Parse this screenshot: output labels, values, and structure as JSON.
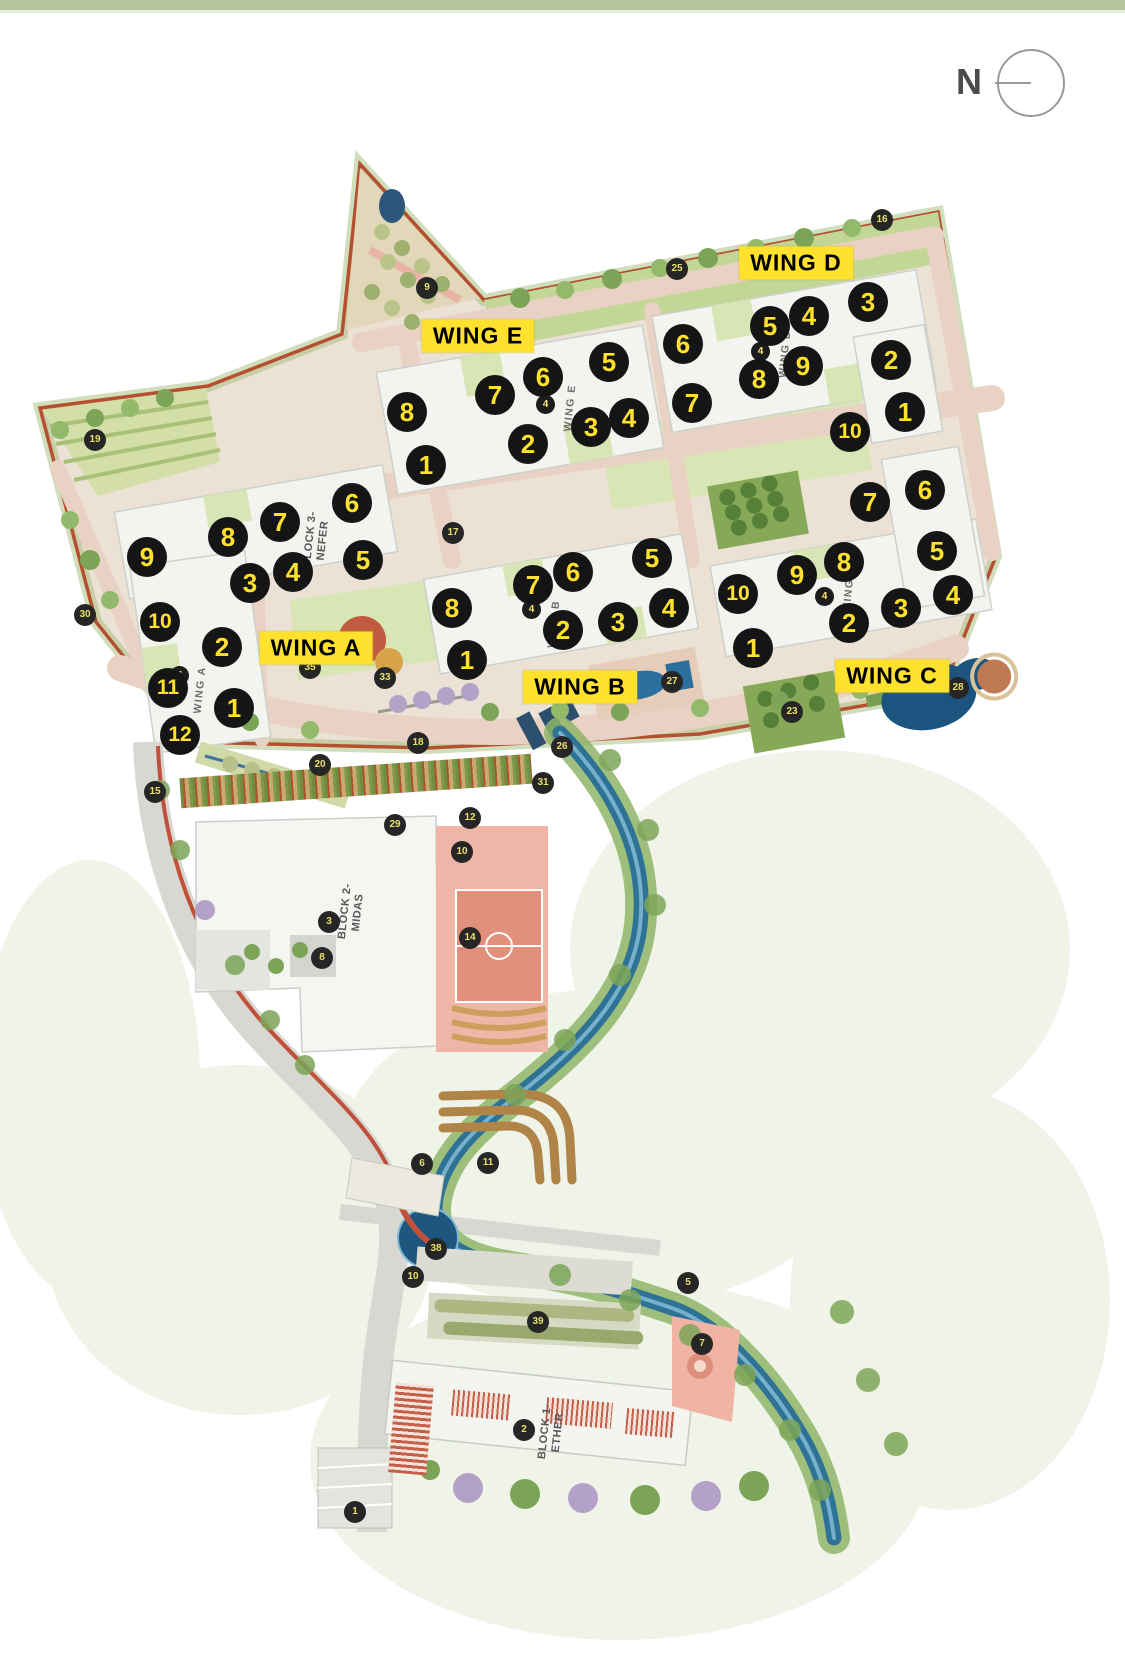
{
  "page": {
    "top_band_color": "#b7c59c",
    "background": "#ffffff"
  },
  "compass": {
    "label": "N"
  },
  "colors": {
    "unit_marker_bg": "#151515",
    "unit_marker_text": "#ffe12e",
    "wing_label_bg": "#ffe12e",
    "wing_label_text": "#000000",
    "boundary_road": "#b5502f",
    "river": "#2e7296"
  },
  "map": {
    "wings": [
      {
        "id": "A",
        "label": "WING A",
        "label_pos": {
          "x": 316,
          "y": 648
        },
        "name_tag": {
          "text": "WING A",
          "x": 200,
          "y": 690
        },
        "mini": {
          "n": "4",
          "x": 180,
          "y": 676
        },
        "units": [
          {
            "n": "1",
            "x": 234,
            "y": 708
          },
          {
            "n": "2",
            "x": 222,
            "y": 647
          },
          {
            "n": "3",
            "x": 250,
            "y": 583
          },
          {
            "n": "4",
            "x": 293,
            "y": 572
          },
          {
            "n": "5",
            "x": 363,
            "y": 560
          },
          {
            "n": "6",
            "x": 352,
            "y": 503
          },
          {
            "n": "7",
            "x": 280,
            "y": 522
          },
          {
            "n": "8",
            "x": 228,
            "y": 537
          },
          {
            "n": "9",
            "x": 147,
            "y": 557
          },
          {
            "n": "10",
            "x": 160,
            "y": 622
          },
          {
            "n": "11",
            "x": 168,
            "y": 688
          },
          {
            "n": "12",
            "x": 180,
            "y": 735
          }
        ]
      },
      {
        "id": "B",
        "label": "WING B",
        "label_pos": {
          "x": 580,
          "y": 687
        },
        "name_tag": {
          "text": "WING B",
          "x": 554,
          "y": 624
        },
        "mini": {
          "n": "4",
          "x": 532,
          "y": 610
        },
        "units": [
          {
            "n": "1",
            "x": 467,
            "y": 660
          },
          {
            "n": "2",
            "x": 563,
            "y": 630
          },
          {
            "n": "3",
            "x": 618,
            "y": 622
          },
          {
            "n": "4",
            "x": 669,
            "y": 608
          },
          {
            "n": "5",
            "x": 652,
            "y": 558
          },
          {
            "n": "6",
            "x": 573,
            "y": 572
          },
          {
            "n": "7",
            "x": 533,
            "y": 585
          },
          {
            "n": "8",
            "x": 452,
            "y": 608
          }
        ]
      },
      {
        "id": "C",
        "label": "WING C",
        "label_pos": {
          "x": 892,
          "y": 676
        },
        "name_tag": {
          "text": "WING C",
          "x": 849,
          "y": 589
        },
        "mini": {
          "n": "4",
          "x": 825,
          "y": 597
        },
        "units": [
          {
            "n": "1",
            "x": 753,
            "y": 648
          },
          {
            "n": "2",
            "x": 849,
            "y": 623
          },
          {
            "n": "3",
            "x": 901,
            "y": 608
          },
          {
            "n": "4",
            "x": 953,
            "y": 595
          },
          {
            "n": "5",
            "x": 937,
            "y": 551
          },
          {
            "n": "6",
            "x": 925,
            "y": 490
          },
          {
            "n": "7",
            "x": 870,
            "y": 502
          },
          {
            "n": "8",
            "x": 844,
            "y": 562
          },
          {
            "n": "9",
            "x": 797,
            "y": 575
          },
          {
            "n": "10",
            "x": 738,
            "y": 594
          }
        ]
      },
      {
        "id": "D",
        "label": "WING D",
        "label_pos": {
          "x": 796,
          "y": 263
        },
        "name_tag": {
          "text": "WING D",
          "x": 785,
          "y": 354
        },
        "mini": {
          "n": "4",
          "x": 761,
          "y": 352
        },
        "units": [
          {
            "n": "1",
            "x": 905,
            "y": 412
          },
          {
            "n": "2",
            "x": 891,
            "y": 360
          },
          {
            "n": "3",
            "x": 868,
            "y": 302
          },
          {
            "n": "4",
            "x": 809,
            "y": 316
          },
          {
            "n": "5",
            "x": 770,
            "y": 326
          },
          {
            "n": "6",
            "x": 683,
            "y": 344
          },
          {
            "n": "7",
            "x": 692,
            "y": 403
          },
          {
            "n": "8",
            "x": 759,
            "y": 379
          },
          {
            "n": "9",
            "x": 803,
            "y": 366
          },
          {
            "n": "10",
            "x": 850,
            "y": 432
          }
        ]
      },
      {
        "id": "E",
        "label": "WING E",
        "label_pos": {
          "x": 478,
          "y": 336
        },
        "name_tag": {
          "text": "WING E",
          "x": 570,
          "y": 408
        },
        "mini": {
          "n": "4",
          "x": 546,
          "y": 405
        },
        "units": [
          {
            "n": "1",
            "x": 426,
            "y": 465
          },
          {
            "n": "2",
            "x": 528,
            "y": 444
          },
          {
            "n": "3",
            "x": 591,
            "y": 427
          },
          {
            "n": "4",
            "x": 629,
            "y": 418
          },
          {
            "n": "5",
            "x": 609,
            "y": 362
          },
          {
            "n": "6",
            "x": 543,
            "y": 377
          },
          {
            "n": "7",
            "x": 495,
            "y": 395
          },
          {
            "n": "8",
            "x": 407,
            "y": 412
          }
        ]
      }
    ],
    "blocks": [
      {
        "line1": "BLOCK 3-",
        "line2": "NEFER",
        "x": 317,
        "y": 540
      },
      {
        "line1": "BLOCK 2-",
        "line2": "MIDAS",
        "x": 352,
        "y": 912
      },
      {
        "line1": "BLOCK 1-",
        "line2": "ETHER",
        "x": 552,
        "y": 1432
      }
    ],
    "refs": [
      {
        "n": "9",
        "x": 427,
        "y": 288
      },
      {
        "n": "19",
        "x": 95,
        "y": 440
      },
      {
        "n": "25",
        "x": 677,
        "y": 269
      },
      {
        "n": "16",
        "x": 882,
        "y": 220
      },
      {
        "n": "17",
        "x": 453,
        "y": 533
      },
      {
        "n": "30",
        "x": 85,
        "y": 615
      },
      {
        "n": "35",
        "x": 310,
        "y": 668
      },
      {
        "n": "33",
        "x": 385,
        "y": 678
      },
      {
        "n": "20",
        "x": 320,
        "y": 765
      },
      {
        "n": "28",
        "x": 958,
        "y": 688
      },
      {
        "n": "23",
        "x": 792,
        "y": 712
      },
      {
        "n": "27",
        "x": 672,
        "y": 682
      },
      {
        "n": "26",
        "x": 562,
        "y": 747
      },
      {
        "n": "18",
        "x": 418,
        "y": 743
      },
      {
        "n": "31",
        "x": 543,
        "y": 783
      },
      {
        "n": "15",
        "x": 155,
        "y": 792
      },
      {
        "n": "12",
        "x": 470,
        "y": 818
      },
      {
        "n": "29",
        "x": 395,
        "y": 825
      },
      {
        "n": "10",
        "x": 462,
        "y": 852
      },
      {
        "n": "3",
        "x": 329,
        "y": 922
      },
      {
        "n": "8",
        "x": 322,
        "y": 958
      },
      {
        "n": "14",
        "x": 470,
        "y": 938
      },
      {
        "n": "6",
        "x": 422,
        "y": 1164
      },
      {
        "n": "11",
        "x": 488,
        "y": 1163
      },
      {
        "n": "38",
        "x": 436,
        "y": 1249
      },
      {
        "n": "10",
        "x": 413,
        "y": 1277
      },
      {
        "n": "39",
        "x": 538,
        "y": 1322
      },
      {
        "n": "5",
        "x": 688,
        "y": 1283
      },
      {
        "n": "7",
        "x": 702,
        "y": 1344
      },
      {
        "n": "2",
        "x": 524,
        "y": 1430
      },
      {
        "n": "1",
        "x": 355,
        "y": 1512
      }
    ]
  }
}
